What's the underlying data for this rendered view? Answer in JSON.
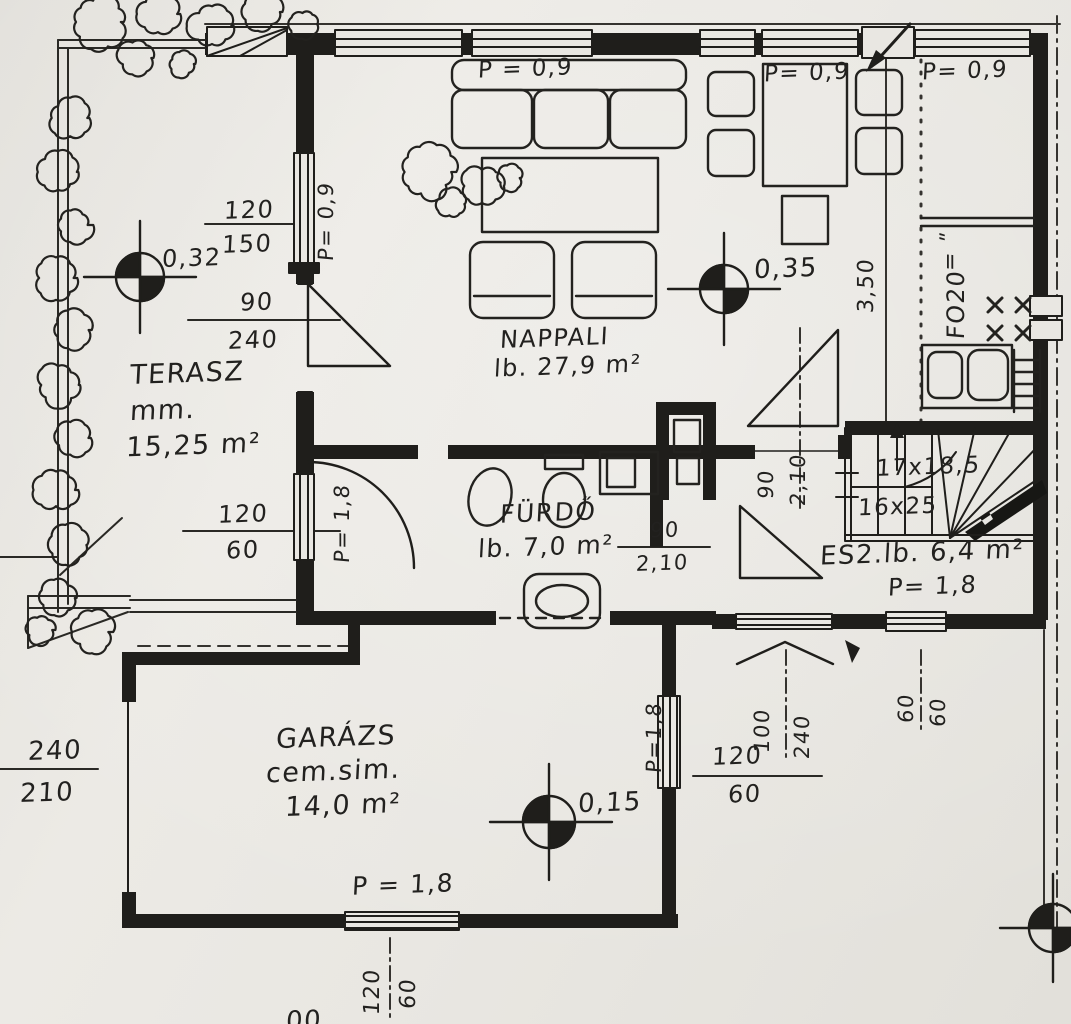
{
  "title": "Scanned hand-drawn ground floor plan (Hungarian)",
  "rooms": {
    "terasz": {
      "name": "TERASZ",
      "sub": "mm.",
      "area": "15,25 m²"
    },
    "nappali": {
      "name": "NAPPALI",
      "area": "lb. 27,9 m²"
    },
    "furdo": {
      "name": "FÜRDŐ",
      "area": "lb. 7,0 m²"
    },
    "stairhall": {
      "name": "ES2.lb. 6,4 m²",
      "parapet": "P= 1,8"
    },
    "garazs": {
      "name": "GARÁZS",
      "sub": "cem.sim.",
      "area": "14,0 m²",
      "parapet": "P = 1,8"
    }
  },
  "stairs": {
    "flight_upper": "17x18,5",
    "flight_lower": "16x25"
  },
  "levels": {
    "terrace": "0,32",
    "living": "0,35",
    "garage": "0,15"
  },
  "parapets": {
    "sofa_window": "P = 0,9",
    "dining_window": "P= 0,9",
    "kitchen_window": "P= 0,9",
    "terrace_door_wall": "P= 0,9",
    "bath_window": "P= 1,8",
    "garage_right_window": "P=1,8"
  },
  "dims": {
    "terrace_window_w": "120",
    "terrace_window_h": "150",
    "terrace_door_w": "90",
    "terrace_door_h": "240",
    "bath_window_w": "120",
    "bath_window_h": "60",
    "bath_door_w": "90",
    "bath_door_h": "2,10",
    "hall_door_w": "90",
    "hall_door_h": "2,10",
    "garage_door_w": "240",
    "garage_door_h": "210",
    "garage_right_window_w": "120",
    "garage_right_window_h": "60",
    "garage_bottom_window_w": "120",
    "garage_bottom_window_h": "60",
    "entry_door_w": "100",
    "entry_door_h": "240",
    "hall_window_w": "60",
    "hall_window_h": "60",
    "storey_height": "3,50",
    "wall_note": "FO20",
    "wall_note_marks": "= ʺ"
  },
  "misc": {
    "bottom_cut_text": "00"
  }
}
